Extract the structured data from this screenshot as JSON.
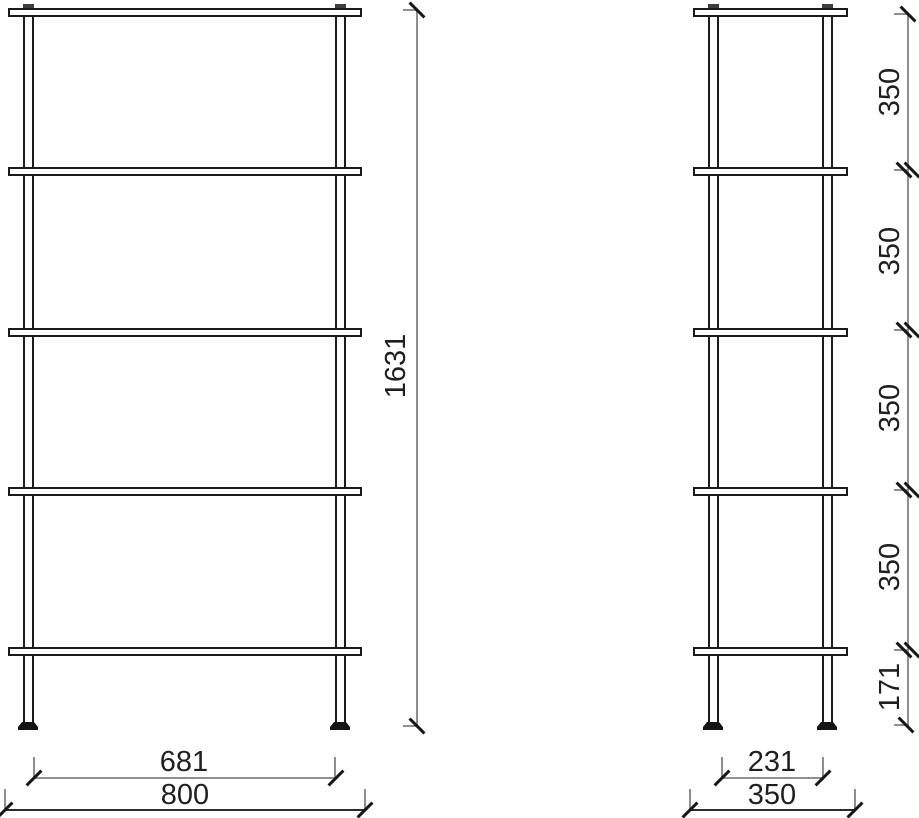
{
  "front_view": {
    "height_dim": "1631",
    "feet_span_dim": "681",
    "width_dim": "800"
  },
  "side_view": {
    "segment_dims": [
      "350",
      "350",
      "350",
      "350",
      "171"
    ],
    "feet_span_dim": "231",
    "depth_dim": "350"
  },
  "colors": {
    "outline": "#1b1b1b",
    "dim_line": "#8f8f8f",
    "text": "#1f1f1f",
    "background": "#ffffff"
  }
}
